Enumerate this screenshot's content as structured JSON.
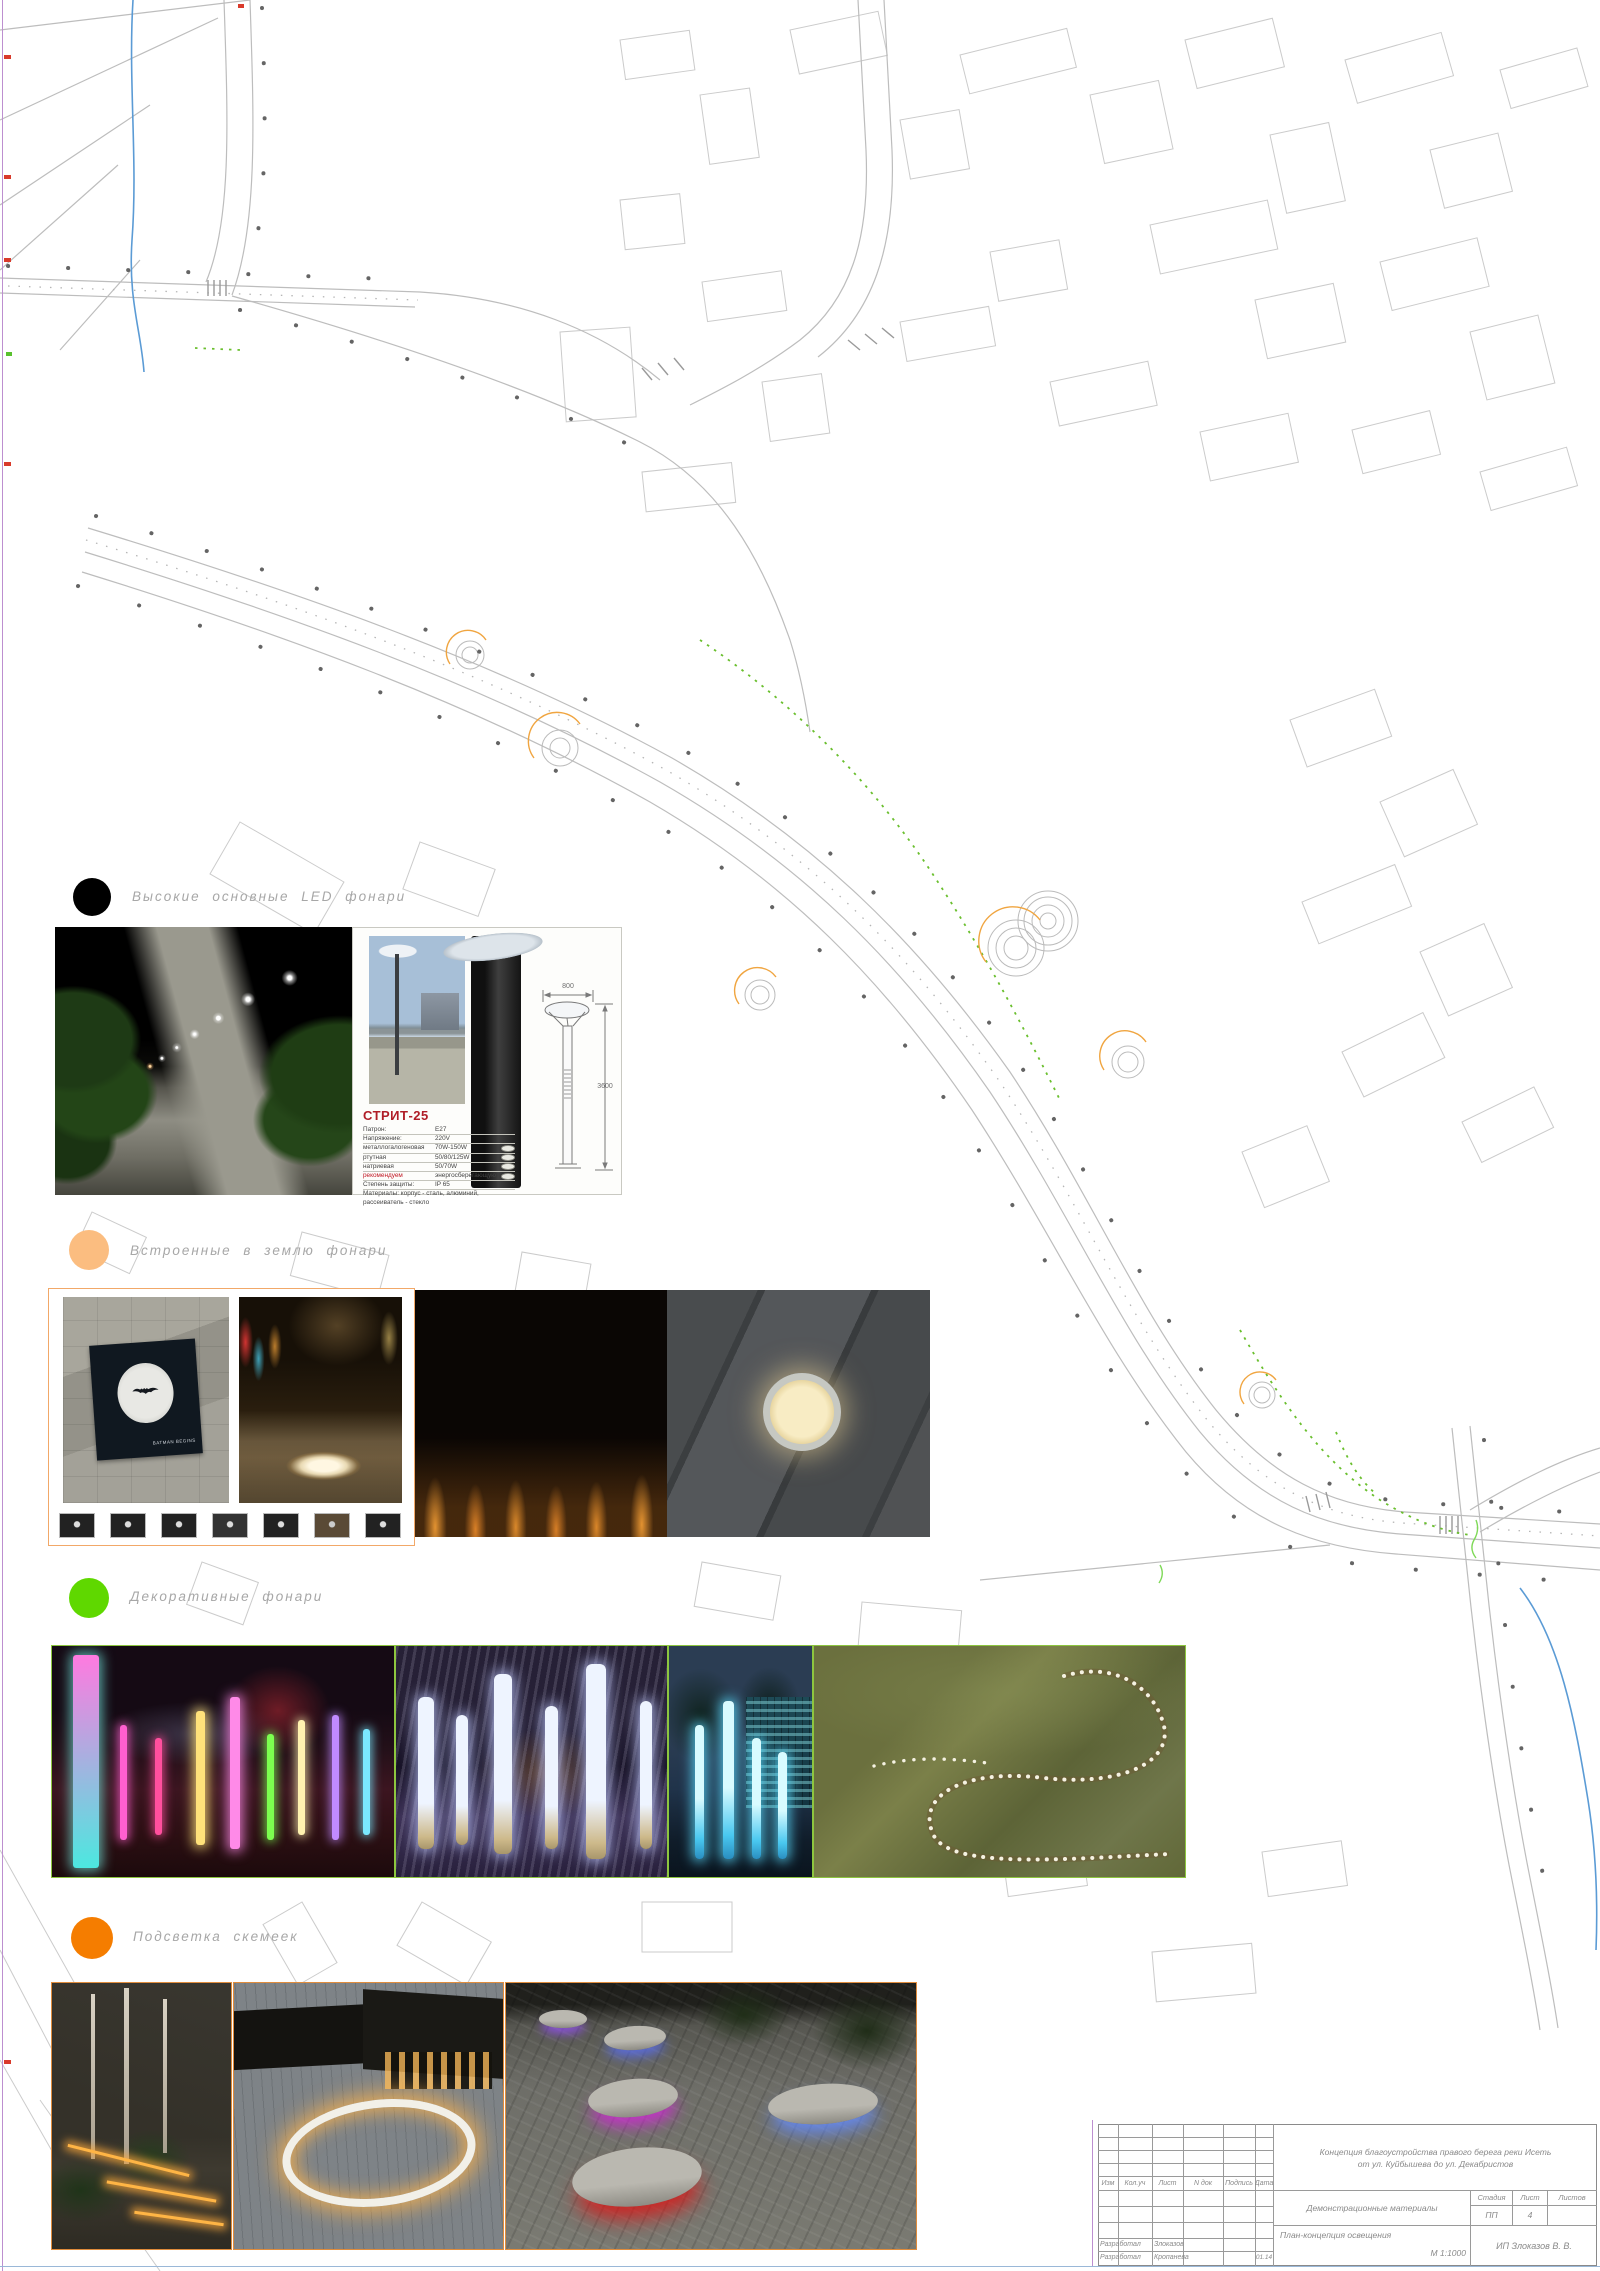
{
  "page": {
    "sheet_bg": "#ffffff",
    "frame_left_color": "#bd8fd0",
    "frame_bottom_color": "#9ab8d8"
  },
  "map": {
    "road_color": "#bdbdbd",
    "building_color": "#cbcbcb",
    "stream_color": "#5b9bd5",
    "decor_path_color": "#6abf2e",
    "plaza_arc_color": "#f0a540",
    "lamp_dot_color": "#4a4a4a"
  },
  "legend": {
    "items": [
      {
        "id": "led-main",
        "color": "#000000",
        "label": "Высокие основные LED фонари"
      },
      {
        "id": "in-ground",
        "color": "#fbbd80",
        "label": "Встроенные в землю фонари"
      },
      {
        "id": "decorative",
        "color": "#5fd800",
        "label": "Декоративные фонари"
      },
      {
        "id": "bench",
        "color": "#f57d00",
        "label": "Подсветка скемеек"
      }
    ]
  },
  "spec_card": {
    "title": "СТРИТ-25",
    "title_color": "#b01e28",
    "rows": [
      {
        "label": "Патрон:",
        "value": "E27"
      },
      {
        "label": "Напряжение:",
        "value": "220V"
      },
      {
        "label": "металлогалогеновая",
        "value": "70W-150W"
      },
      {
        "label": "ртутная",
        "value": "50/80/125W"
      },
      {
        "label": "натриевая",
        "value": "50/70W"
      },
      {
        "label": "рекомендуем",
        "value": "энергосберегающую"
      },
      {
        "label": "Степень защиты:",
        "value": "IP 65"
      },
      {
        "label": "Материалы: корпус - сталь, алюминий,",
        "value": ""
      },
      {
        "label": "рассеиватель - стекло",
        "value": ""
      }
    ],
    "dimensions": {
      "width": "800",
      "height": "3600"
    }
  },
  "photos": {
    "batman_caption": "BATMAN BEGINS"
  },
  "title_block": {
    "project_line1": "Концепция благоустройства правого берега реки Исеть",
    "project_line2": "от ул. Куйбышева до ул. Декабристов",
    "doc_type": "Демонстрационные материалы",
    "sheet_name": "План-концепция освещения",
    "scale": "М 1:1000",
    "company": "ИП Злоказов В. В.",
    "stage_label": "Стадия",
    "sheet_label": "Лист",
    "sheets_label": "Листов",
    "stage_value": "ПП",
    "sheet_value": "4",
    "sheets_value": "",
    "columns": [
      "Изм",
      "Кол.уч",
      "Лист",
      "N док",
      "Подпись",
      "Дата"
    ],
    "signature_rows": [
      {
        "role": "Разработал",
        "name": "Злоказов",
        "date": ""
      },
      {
        "role": "Разработал",
        "name": "Кропанева",
        "date": "01.14"
      }
    ]
  }
}
